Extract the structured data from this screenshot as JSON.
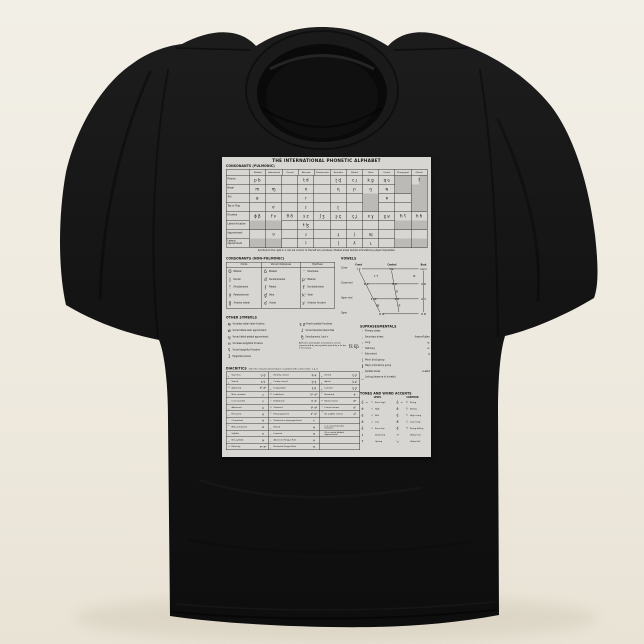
{
  "scene": {
    "background_top": "#f2efe7",
    "background_bottom": "#e9e3d6",
    "shirt_color": "#161616",
    "print_color": "#d7d6d2"
  },
  "chart": {
    "title": "THE INTERNATIONAL PHONETIC ALPHABET",
    "pulmonic": {
      "heading": "CONSONANTS (PULMONIC)",
      "columns": [
        "Bilabial",
        "Labiodental",
        "Dental",
        "Alveolar",
        "Postalveolar",
        "Retroflex",
        "Palatal",
        "Velar",
        "Uvular",
        "Pharyngeal",
        "Glottal"
      ],
      "rows": [
        {
          "label": "Plosive",
          "cells": [
            {
              "t": "p b"
            },
            {
              "t": ""
            },
            {
              "t": ""
            },
            {
              "t": "t d"
            },
            {
              "t": ""
            },
            {
              "t": "ʈ ɖ"
            },
            {
              "t": "c ɟ"
            },
            {
              "t": "k ɡ"
            },
            {
              "t": "q ɢ"
            },
            {
              "t": "",
              "c": "sh"
            },
            {
              "t": "ʔ",
              "c": "shR"
            }
          ]
        },
        {
          "label": "Nasal",
          "cells": [
            {
              "t": "m"
            },
            {
              "t": "ɱ"
            },
            {
              "t": ""
            },
            {
              "t": "n"
            },
            {
              "t": ""
            },
            {
              "t": "ɳ"
            },
            {
              "t": "ɲ"
            },
            {
              "t": "ŋ"
            },
            {
              "t": "ɴ"
            },
            {
              "t": "",
              "c": "sh"
            },
            {
              "t": "",
              "c": "sh"
            }
          ]
        },
        {
          "label": "Trill",
          "cells": [
            {
              "t": "ʙ"
            },
            {
              "t": ""
            },
            {
              "t": ""
            },
            {
              "t": "r"
            },
            {
              "t": ""
            },
            {
              "t": ""
            },
            {
              "t": ""
            },
            {
              "t": "",
              "c": "sh"
            },
            {
              "t": "ʀ"
            },
            {
              "t": ""
            },
            {
              "t": "",
              "c": "sh"
            }
          ]
        },
        {
          "label": "Tap or Flap",
          "cells": [
            {
              "t": ""
            },
            {
              "t": "ⱱ"
            },
            {
              "t": ""
            },
            {
              "t": "ɾ"
            },
            {
              "t": ""
            },
            {
              "t": "ɽ"
            },
            {
              "t": ""
            },
            {
              "t": "",
              "c": "sh"
            },
            {
              "t": ""
            },
            {
              "t": ""
            },
            {
              "t": "",
              "c": "sh"
            }
          ]
        },
        {
          "label": "Fricative",
          "cells": [
            {
              "t": "ɸ β"
            },
            {
              "t": "f v"
            },
            {
              "t": "θ ð"
            },
            {
              "t": "s z"
            },
            {
              "t": "ʃ ʒ"
            },
            {
              "t": "ʂ ʐ"
            },
            {
              "t": "ç ʝ"
            },
            {
              "t": "x ɣ"
            },
            {
              "t": "χ ʁ"
            },
            {
              "t": "ħ ʕ"
            },
            {
              "t": "h ɦ"
            }
          ]
        },
        {
          "label": "Lateral fricative",
          "cells": [
            {
              "t": "",
              "c": "sh"
            },
            {
              "t": "",
              "c": "sh"
            },
            {
              "t": ""
            },
            {
              "t": "ɬ ɮ"
            },
            {
              "t": ""
            },
            {
              "t": ""
            },
            {
              "t": ""
            },
            {
              "t": ""
            },
            {
              "t": ""
            },
            {
              "t": "",
              "c": "sh"
            },
            {
              "t": "",
              "c": "sh"
            }
          ]
        },
        {
          "label": "Approximant",
          "cells": [
            {
              "t": ""
            },
            {
              "t": "ʋ"
            },
            {
              "t": ""
            },
            {
              "t": "ɹ"
            },
            {
              "t": ""
            },
            {
              "t": "ɻ"
            },
            {
              "t": "j"
            },
            {
              "t": "ɰ"
            },
            {
              "t": ""
            },
            {
              "t": ""
            },
            {
              "t": ""
            }
          ]
        },
        {
          "label": "Lateral approximant",
          "cells": [
            {
              "t": "",
              "c": "sh"
            },
            {
              "t": "",
              "c": "sh"
            },
            {
              "t": ""
            },
            {
              "t": "l"
            },
            {
              "t": ""
            },
            {
              "t": "ɭ"
            },
            {
              "t": "ʎ"
            },
            {
              "t": "ʟ"
            },
            {
              "t": ""
            },
            {
              "t": "",
              "c": "sh"
            },
            {
              "t": "",
              "c": "sh"
            }
          ]
        }
      ],
      "footnote": "Symbols to the right in a cell are voiced, to the left are voiceless. Shaded areas denote articulations judged impossible."
    },
    "nonpulmonic": {
      "heading": "CONSONANTS (NON-PULMONIC)",
      "col_headers": [
        "Clicks",
        "Voiced implosives",
        "Ejectives"
      ],
      "clicks": [
        {
          "s": "ʘ",
          "l": "Bilabial"
        },
        {
          "s": "ǀ",
          "l": "Dental"
        },
        {
          "s": "ǃ",
          "l": "(Post)alveolar"
        },
        {
          "s": "ǂ",
          "l": "Palatoalveolar"
        },
        {
          "s": "ǁ",
          "l": "Alveolar lateral"
        }
      ],
      "implosives": [
        {
          "s": "ɓ",
          "l": "Bilabial"
        },
        {
          "s": "ɗ",
          "l": "Dental/alveolar"
        },
        {
          "s": "ʄ",
          "l": "Palatal"
        },
        {
          "s": "ɠ",
          "l": "Velar"
        },
        {
          "s": "ʛ",
          "l": "Uvular"
        }
      ],
      "ejectives": [
        {
          "s": "ʼ",
          "l": "Examples:"
        },
        {
          "s": "pʼ",
          "l": "Bilabial"
        },
        {
          "s": "tʼ",
          "l": "Dental/alveolar"
        },
        {
          "s": "kʼ",
          "l": "Velar"
        },
        {
          "s": "sʼ",
          "l": "Alveolar fricative"
        }
      ]
    },
    "vowels": {
      "heading": "VOWELS",
      "axis": [
        "Front",
        "Central",
        "Back"
      ],
      "row_labels": [
        "Close",
        "Close-mid",
        "Open-mid",
        "Open"
      ],
      "glyphs": [
        "i y",
        "ɨ ʉ",
        "ɯ u",
        "ɪ ʏ",
        "ʊ",
        "e ø",
        "ɘ ɵ",
        "ɤ o",
        "ə",
        "ɛ œ",
        "ɜ ɞ",
        "ʌ ɔ",
        "æ",
        "ɐ",
        "a ɶ",
        "ɑ ɒ"
      ]
    },
    "other_symbols": {
      "heading": "OTHER SYMBOLS",
      "left": [
        {
          "s": "ʍ",
          "l": "Voiceless labial-velar fricative"
        },
        {
          "s": "w",
          "l": "Voiced labial-velar approximant"
        },
        {
          "s": "ɥ",
          "l": "Voiced labial-palatal approximant"
        },
        {
          "s": "ʜ",
          "l": "Voiceless epiglottal fricative"
        },
        {
          "s": "ʢ",
          "l": "Voiced epiglottal fricative"
        },
        {
          "s": "ʡ",
          "l": "Epiglottal plosive"
        }
      ],
      "right": [
        {
          "s": "ɕ ʑ",
          "l": "Alveolo-palatal fricatives"
        },
        {
          "s": "ɺ",
          "l": "Voiced alveolar lateral flap"
        },
        {
          "s": "ɧ",
          "l": "Simultaneous ʃ and x"
        }
      ],
      "note": "Affricates and double articulations can be represented by two symbols joined by a tie bar if necessary.",
      "note_examples": "t͡s  k͡p"
    },
    "suprasegmentals": {
      "heading": "SUPRASEGMENTALS",
      "items": [
        {
          "s": "ˈ",
          "l": "Primary stress",
          "e": ""
        },
        {
          "s": "ˌ",
          "l": "Secondary stress",
          "e": "ˌfoʊnəˈtɪʃən"
        },
        {
          "s": "ː",
          "l": "Long",
          "e": "eː"
        },
        {
          "s": "ˑ",
          "l": "Half-long",
          "e": "eˑ"
        },
        {
          "s": " ̆",
          "l": "Extra-short",
          "e": "ĕ"
        },
        {
          "s": "|",
          "l": "Minor (foot) group",
          "e": ""
        },
        {
          "s": "‖",
          "l": "Major (intonation) group",
          "e": ""
        },
        {
          "s": ".",
          "l": "Syllable break",
          "e": "ɹi.ækt"
        },
        {
          "s": "‿",
          "l": "Linking (absence of a break)",
          "e": ""
        }
      ]
    },
    "tones": {
      "heading": "TONES AND WORD ACCENTS",
      "level_label": "LEVEL",
      "contour_label": "CONTOUR",
      "level": [
        {
          "s": "e̋",
          "o": "or",
          "b": "˥",
          "l": "Extra high"
        },
        {
          "s": "é",
          "o": "",
          "b": "˦",
          "l": "High"
        },
        {
          "s": "ē",
          "o": "",
          "b": "˧",
          "l": "Mid"
        },
        {
          "s": "è",
          "o": "",
          "b": "˨",
          "l": "Low"
        },
        {
          "s": "ȅ",
          "o": "",
          "b": "˩",
          "l": "Extra low"
        },
        {
          "s": "↓",
          "o": "",
          "b": "",
          "l": "Downstep"
        },
        {
          "s": "↑",
          "o": "",
          "b": "",
          "l": "Upstep"
        }
      ],
      "contour": [
        {
          "s": "ě",
          "o": "or",
          "b": "˩˥",
          "l": "Rising"
        },
        {
          "s": "ê",
          "o": "",
          "b": "˥˩",
          "l": "Falling"
        },
        {
          "s": "e᷄",
          "o": "",
          "b": "˧˥",
          "l": "High rising"
        },
        {
          "s": "e᷅",
          "o": "",
          "b": "˩˧",
          "l": "Low rising"
        },
        {
          "s": "e᷈",
          "o": "",
          "b": "˧˦˧",
          "l": "Rising-falling"
        },
        {
          "s": "↗",
          "o": "",
          "b": "",
          "l": "Global rise"
        },
        {
          "s": "↘",
          "o": "",
          "b": "",
          "l": "Global fall"
        }
      ]
    },
    "diacritics": {
      "heading": "DIACRITICS",
      "note": "Diacritics may be placed above a symbol with a descender, e.g. ŋ̊",
      "rows": [
        {
          "c1": {
            "s": " ̥",
            "l": "Voiceless",
            "e": "n̥ d̥"
          },
          "c2": {
            "s": " ̤",
            "l": "Breathy voiced",
            "e": "b̤ a̤"
          },
          "c3": {
            "s": " ̪",
            "l": "Dental",
            "e": "t̪ d̪"
          }
        },
        {
          "c1": {
            "s": " ̬",
            "l": "Voiced",
            "e": "s̬ t̬"
          },
          "c2": {
            "s": " ̰",
            "l": "Creaky voiced",
            "e": "b̰ a̰"
          },
          "c3": {
            "s": " ̺",
            "l": "Apical",
            "e": "t̺ d̺"
          }
        },
        {
          "c1": {
            "s": "ʰ",
            "l": "Aspirated",
            "e": "tʰ dʰ"
          },
          "c2": {
            "s": " ̼",
            "l": "Linguolabial",
            "e": "t̼ d̼"
          },
          "c3": {
            "s": " ̻",
            "l": "Laminal",
            "e": "t̻ d̻"
          }
        },
        {
          "c1": {
            "s": " ̹",
            "l": "More rounded",
            "e": "ɔ̹"
          },
          "c2": {
            "s": "ʷ",
            "l": "Labialized",
            "e": "tʷ dʷ"
          },
          "c3": {
            "s": " ̃",
            "l": "Nasalized",
            "e": "ẽ"
          }
        },
        {
          "c1": {
            "s": " ̜",
            "l": "Less rounded",
            "e": "ɔ̜"
          },
          "c2": {
            "s": "ʲ",
            "l": "Palatalized",
            "e": "tʲ dʲ"
          },
          "c3": {
            "s": "ⁿ",
            "l": "Nasal release",
            "e": "dⁿ"
          }
        },
        {
          "c1": {
            "s": " ̟",
            "l": "Advanced",
            "e": "u̟"
          },
          "c2": {
            "s": "ˠ",
            "l": "Velarized",
            "e": "tˠ dˠ"
          },
          "c3": {
            "s": "ˡ",
            "l": "Lateral release",
            "e": "dˡ"
          }
        },
        {
          "c1": {
            "s": " ̠",
            "l": "Retracted",
            "e": "e̠"
          },
          "c2": {
            "s": "ˤ",
            "l": "Pharyngealized",
            "e": "tˤ dˤ"
          },
          "c3": {
            "s": " ̚",
            "l": "No audible release",
            "e": "d̚"
          }
        },
        {
          "c1": {
            "s": " ̈",
            "l": "Centralized",
            "e": "ë"
          },
          "c2": {
            "s": " ̴",
            "l": "Velarized or pharyngealized",
            "e": "ɫ"
          },
          "c3": {
            "s": "",
            "l": "",
            "e": ""
          }
        },
        {
          "c1": {
            "s": " ̽",
            "l": "Mid-centralized",
            "e": "e̽"
          },
          "c2": {
            "s": " ̝",
            "l": "Raised",
            "e": "e̝"
          },
          "c3": {
            "s": "",
            "l": "(ɹ̝ = voiced alveolar fricative)",
            "e": ""
          }
        },
        {
          "c1": {
            "s": " ̩",
            "l": "Syllabic",
            "e": "n̩"
          },
          "c2": {
            "s": " ̞",
            "l": "Lowered",
            "e": "e̞"
          },
          "c3": {
            "s": "",
            "l": "(β̞ = voiced bilabial approximant)",
            "e": ""
          }
        },
        {
          "c1": {
            "s": " ̯",
            "l": "Non-syllabic",
            "e": "e̯"
          },
          "c2": {
            "s": " ̘",
            "l": "Advanced Tongue Root",
            "e": "e̘"
          },
          "c3": {
            "s": "",
            "l": "",
            "e": ""
          }
        },
        {
          "c1": {
            "s": "˞",
            "l": "Rhoticity",
            "e": "ə˞ a˞"
          },
          "c2": {
            "s": " ̙",
            "l": "Retracted Tongue Root",
            "e": "e̙"
          },
          "c3": {
            "s": "",
            "l": "",
            "e": ""
          }
        }
      ]
    }
  }
}
